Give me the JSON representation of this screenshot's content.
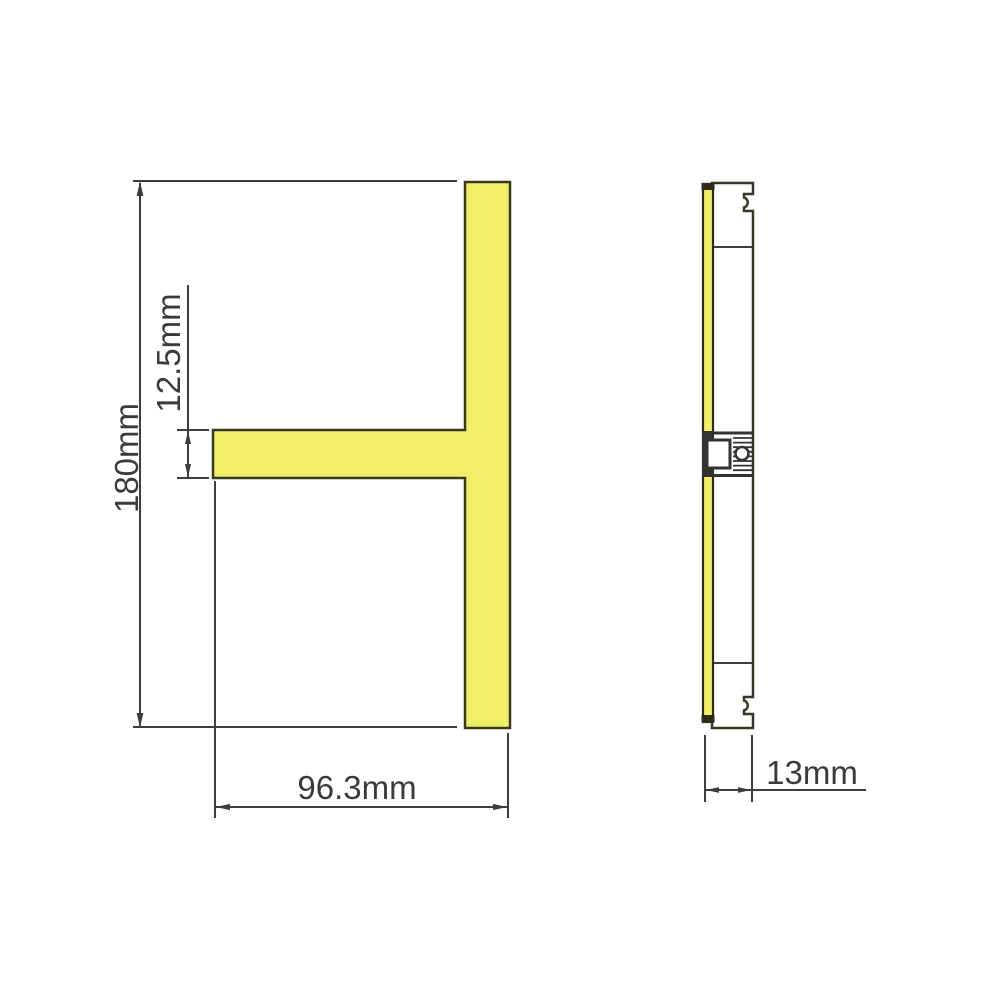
{
  "diagram": {
    "front_view": {
      "height_label": "180mm",
      "arm_thickness_label": "12.5mm",
      "width_label": "96.3mm"
    },
    "side_view": {
      "depth_label": "13mm"
    },
    "colors": {
      "profile_fill": "#f2ee68",
      "profile_stroke": "#3a3722",
      "line": "#3d3d3d",
      "text": "#3a3a3a",
      "background": "#ffffff"
    }
  }
}
